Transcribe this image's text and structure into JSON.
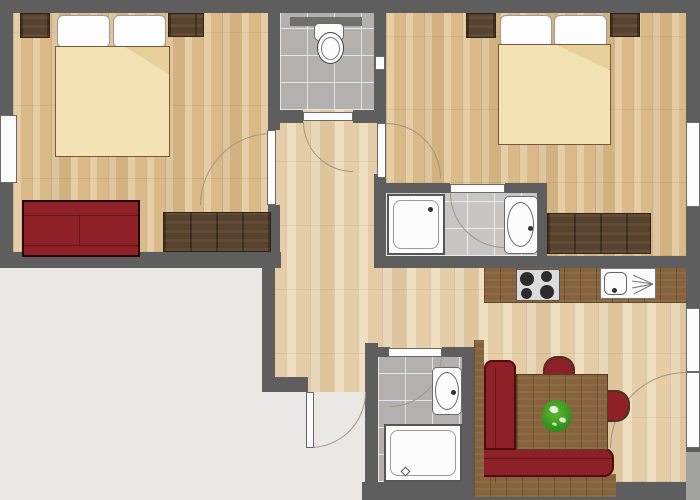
{
  "plan": {
    "type": "apartment-floor-plan",
    "canvas": {
      "width": 700,
      "height": 500
    },
    "rooms": [
      {
        "id": "bedroom-left",
        "furniture": [
          "double-bed",
          "wardrobe-left",
          "wardrobe-right",
          "red-sofa",
          "dresser"
        ],
        "windows": 1,
        "door": "hinged"
      },
      {
        "id": "wc",
        "furniture": [
          "toilet",
          "wall-shelf"
        ],
        "door": "hinged"
      },
      {
        "id": "bedroom-right",
        "furniture": [
          "double-bed",
          "wardrobe-left",
          "wardrobe-right",
          "dresser"
        ],
        "windows": 1,
        "door": "hinged"
      },
      {
        "id": "bathroom-ensuite",
        "furniture": [
          "shower",
          "washbasin"
        ],
        "door": "hinged"
      },
      {
        "id": "hallway",
        "furniture": [],
        "door": "entrance"
      },
      {
        "id": "kitchen",
        "furniture": [
          "counter",
          "stove-4-burners",
          "sink-with-drainer"
        ]
      },
      {
        "id": "bathroom-entry",
        "furniture": [
          "shower",
          "washbasin"
        ],
        "door": "hinged"
      },
      {
        "id": "living-dining",
        "furniture": [
          "corner-bench",
          "dining-table",
          "potted-plant",
          "chair-top",
          "chair-right"
        ],
        "windows": 1,
        "door": "balcony"
      }
    ],
    "door_count": 7,
    "window_count": 4
  },
  "colors": {
    "wall": "#5e5e5e",
    "outside": "#e9e8e5",
    "floor_bedroom": "#e2c596",
    "floor_hall": "#ecd8b4",
    "tile": "#b2b1af",
    "tile_light": "#c7c6c4",
    "wood_dark": "#57432d",
    "wood_mid": "#86633d",
    "red": "#8e2027",
    "blanket": "#f3e2b4",
    "blanket_fold": "#e8d09c",
    "fixture_white": "#fcfcfc",
    "fixture_border": "#6a6a6a",
    "arc": "#a39781",
    "plant_green": "#2f8c1d",
    "plant_light": "#5fb832",
    "shelf_gray": "#6f6f6d"
  }
}
